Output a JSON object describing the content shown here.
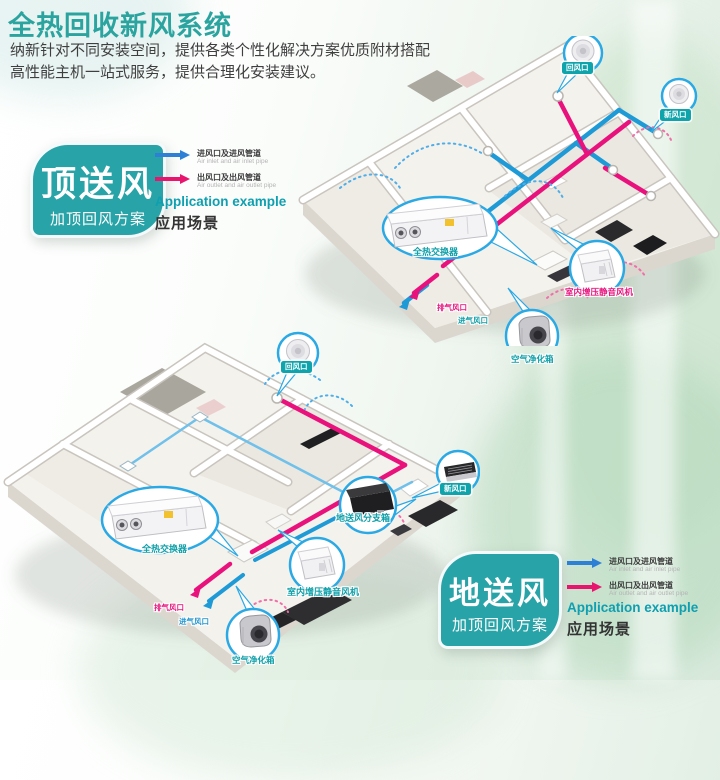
{
  "header": {
    "title": "全热回收新风系统",
    "subtitle_line1": "纳新针对不同安装空间，提供各类个性化解决方案优质附材搭配",
    "subtitle_line2": "高性能主机一站式服务，提供合理化安装建议。"
  },
  "scheme_top": {
    "name": "顶送风",
    "plan": "加顶回风方案"
  },
  "scheme_bottom": {
    "name": "地送风",
    "plan": "加顶回风方案"
  },
  "legend": {
    "inlet_cn": "进风口及进风管道",
    "inlet_en": "Air inlet and air inlet pipe",
    "outlet_cn": "出风口及出风管道",
    "outlet_en": "Air outlet and air outlet pipe",
    "application_en": "Application example",
    "application_cn": "应用场景"
  },
  "house_top": {
    "labels": {
      "return_air": "回风口",
      "fresh_air": "新风口",
      "heat_exchanger": "全热交换器",
      "booster_fan": "室内增压静音风机",
      "exhaust_vent": "排气风口",
      "intake_vent": "进气风口",
      "air_purifier": "空气净化箱"
    }
  },
  "house_bottom": {
    "labels": {
      "return_air": "回风口",
      "fresh_air": "新风口",
      "floor_branch_box": "地送风分支箱",
      "heat_exchanger": "全热交换器",
      "booster_fan": "室内增压静音风机",
      "exhaust_vent": "排气风口",
      "intake_vent": "进气风口",
      "air_purifier": "空气净化箱"
    }
  },
  "colors": {
    "title_teal": "#2ba49f",
    "scheme_teal": "#28a3a7",
    "label_pill_teal": "#0fa3ab",
    "duct_inlet_blue": "#1e9ad6",
    "duct_outlet_magenta": "#e9117c",
    "legend_arrow_blue": "#2e7fd6",
    "legend_arrow_magenta": "#e8146e"
  }
}
